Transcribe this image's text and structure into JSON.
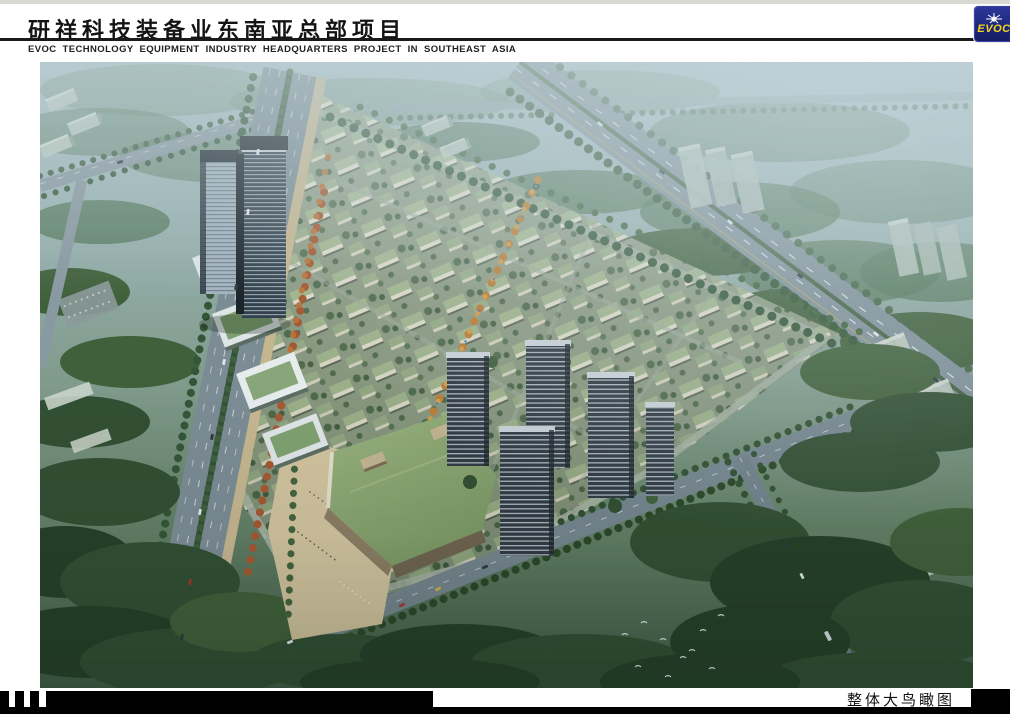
{
  "header": {
    "title_zh": "研祥科技装备业东南亚总部项目",
    "title_en": "EVOC TECHNOLOGY EQUIPMENT INDUSTRY HEADQUARTERS PROJECT IN SOUTHEAST ASIA",
    "logo": {
      "text": "EVOC",
      "icon": "starburst-icon",
      "bg_color": "#1e2878",
      "text_color": "#f2d41a"
    }
  },
  "main_image": {
    "kind": "aerial-birdseye-architectural-rendering",
    "alt": "整体大鸟瞰图 — bird's-eye rendering of the EVOC campus master plan with twin office towers, green-roof low-rise campus blocks, residential high-rises, mall with green roof and surrounding tree-lined roads"
  },
  "footer": {
    "caption": "整体大鸟瞰图"
  },
  "colors": {
    "rule": "#1a1a1a",
    "footer_bar": "#000000"
  }
}
